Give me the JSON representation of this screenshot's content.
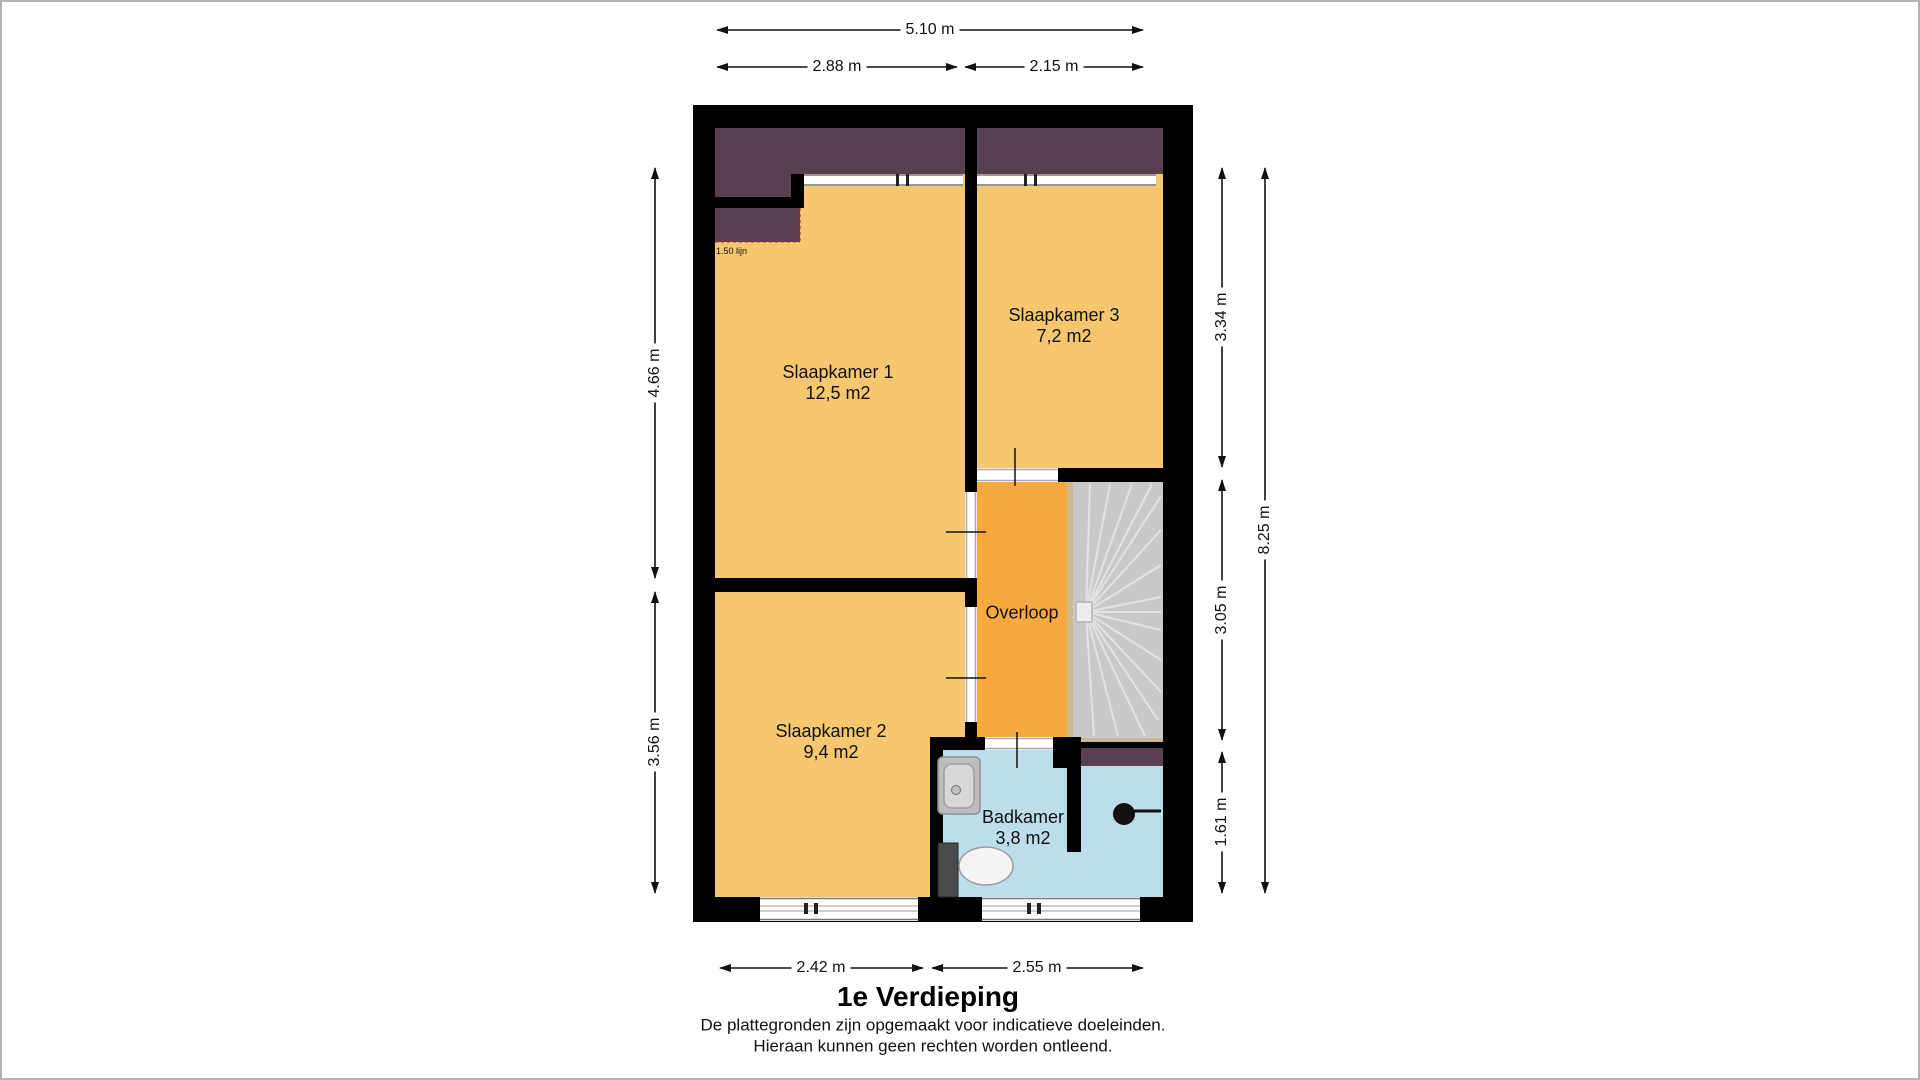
{
  "floorplan": {
    "title": "1e Verdieping",
    "disclaimer": {
      "line1": "De plattegronden zijn opgemaakt voor indicatieve doeleinden.",
      "line2": "Hieraan kunnen geen rechten worden ontleend."
    },
    "rooms": [
      {
        "name": "Slaapkamer 1",
        "area": "12,5 m2"
      },
      {
        "name": "Slaapkamer 3",
        "area": "7,2 m2"
      },
      {
        "name": "Slaapkamer 2",
        "area": "9,4 m2"
      },
      {
        "name": "Overloop",
        "area": ""
      },
      {
        "name": "Badkamer",
        "area": "3,8 m2"
      }
    ],
    "annotations": {
      "attic_line": "1.50 lijn"
    },
    "dimensions": {
      "top": [
        {
          "label": "5.10 m"
        },
        {
          "label": "2.88 m"
        },
        {
          "label": "2.15 m"
        }
      ],
      "bottom": [
        {
          "label": "2.42 m"
        },
        {
          "label": "2.55 m"
        }
      ],
      "left": [
        {
          "label": "4.66 m"
        },
        {
          "label": "3.56 m"
        }
      ],
      "right": [
        {
          "label": "3.34 m"
        },
        {
          "label": "3.05 m"
        },
        {
          "label": "1.61 m"
        },
        {
          "label": "8.25 m"
        }
      ]
    },
    "colors": {
      "room_fill": "#f6c76f",
      "landing_fill": "#f7a93f",
      "bathroom_fill": "#bcdeea",
      "attic_fill": "#584050",
      "stairs_fill": "#c9c9c9",
      "stairs_edge": "#cdb98f",
      "wall": "#000000"
    }
  }
}
